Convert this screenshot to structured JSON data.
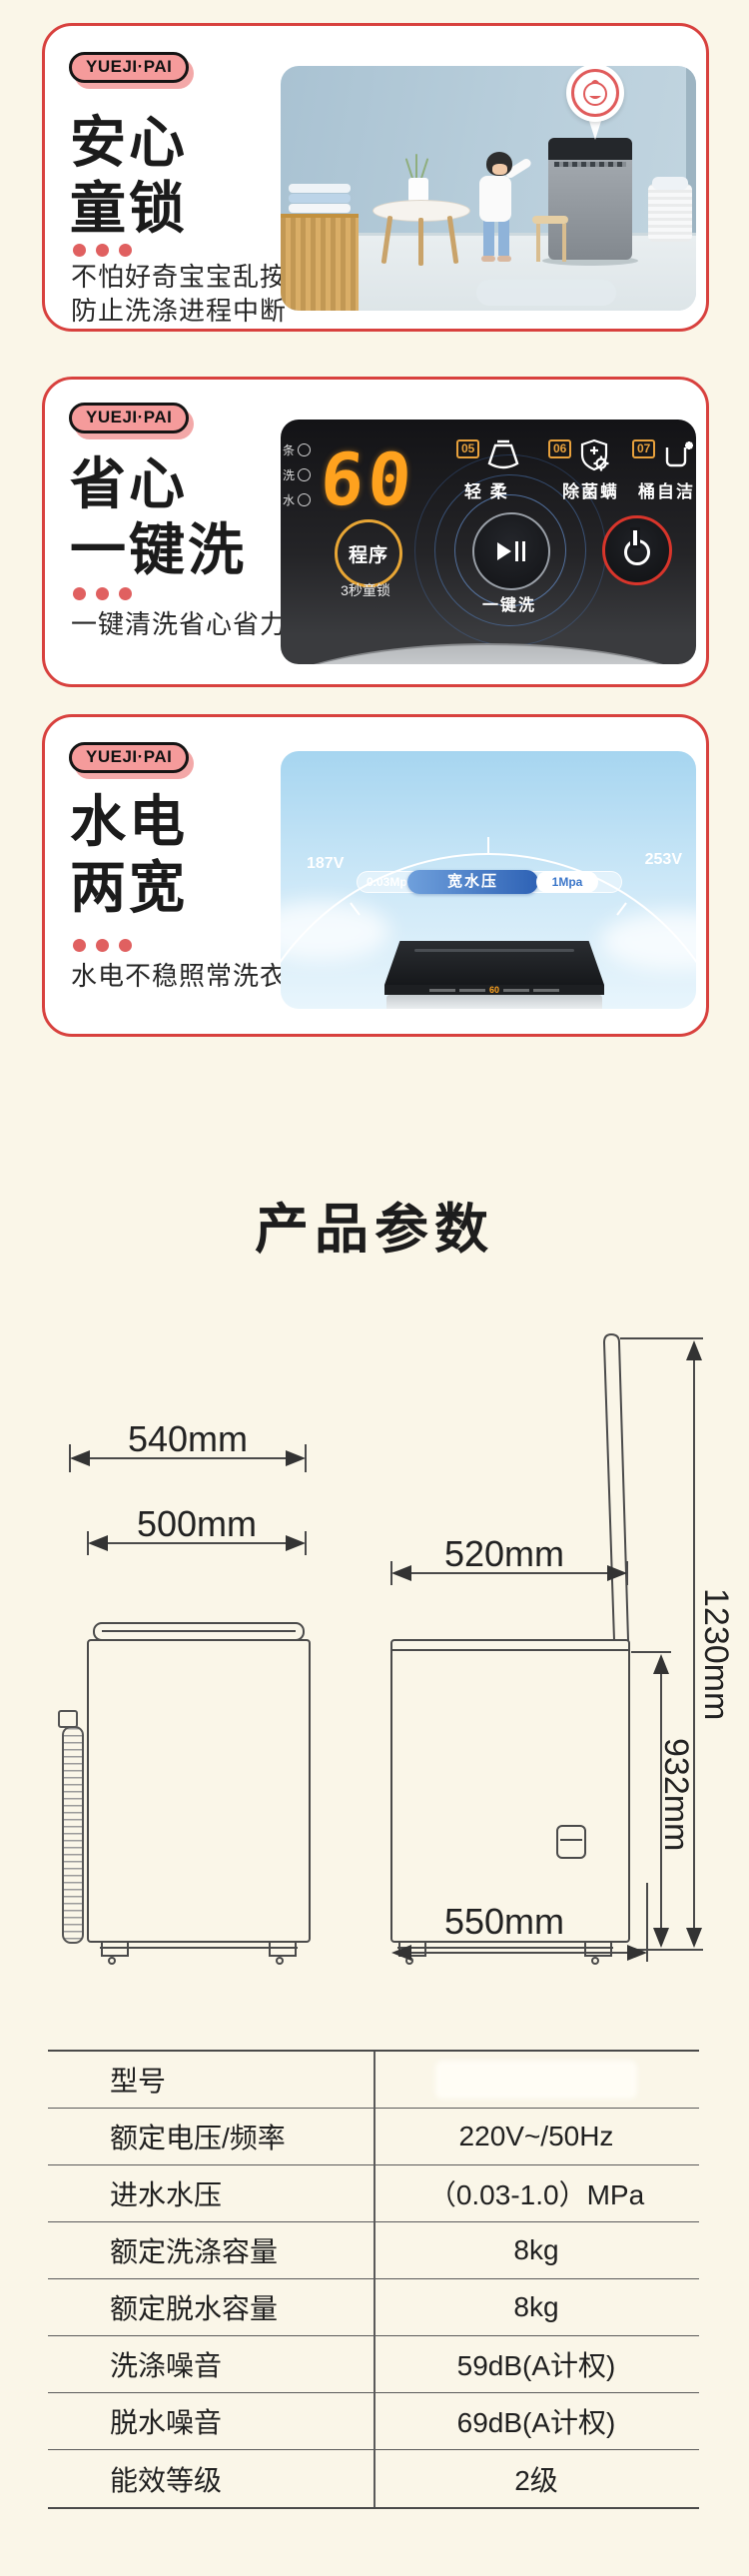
{
  "brand_badge": "YUEJI·PAI",
  "cards": [
    {
      "title": [
        "安心",
        "童锁"
      ],
      "desc": [
        "不怕好奇宝宝乱按",
        "防止洗涤进程中断"
      ]
    },
    {
      "title": [
        "省心",
        "一键洗"
      ],
      "desc": [
        "一键清洗省心省力"
      ],
      "panel": {
        "display": "60",
        "indicators": [
          "条",
          "洗",
          "水"
        ],
        "programs": [
          {
            "num": "05",
            "label": "轻 柔"
          },
          {
            "num": "06",
            "label": "除菌螨"
          },
          {
            "num": "07",
            "label": "桶自洁"
          }
        ],
        "program_button": "程序",
        "program_hint": "3秒童锁",
        "onekey_label": "一键洗"
      }
    },
    {
      "title": [
        "水电",
        "两宽"
      ],
      "desc": [
        "水电不稳照常洗衣"
      ],
      "gauge": {
        "voltage_min": "187V",
        "voltage_max": "253V",
        "pressure_min": "0.03Mpa",
        "pressure_label": "宽水压",
        "pressure_max": "1Mpa",
        "machine_display": "60"
      }
    }
  ],
  "section_title": "产品参数",
  "diagram": {
    "top_width": "540mm",
    "lid_width": "500mm",
    "side_width": "520mm",
    "total_height": "1230mm",
    "body_height": "932mm",
    "base_depth": "550mm"
  },
  "spec_table": {
    "rows": [
      {
        "label": "型号",
        "value": ""
      },
      {
        "label": "额定电压/频率",
        "value": "220V~/50Hz"
      },
      {
        "label": "进水水压",
        "value": "（0.03-1.0）MPa"
      },
      {
        "label": "额定洗涤容量",
        "value": "8kg"
      },
      {
        "label": "额定脱水容量",
        "value": "8kg"
      },
      {
        "label": "洗涤噪音",
        "value": "59dB(A计权)"
      },
      {
        "label": "脱水噪音",
        "value": "69dB(A计权)"
      },
      {
        "label": "能效等级",
        "value": "2级"
      }
    ]
  },
  "colors": {
    "page_bg": "#faf6e8",
    "card_border": "#d8413e",
    "badge_pink": "#f59b9b",
    "accent_dot_red": "#e06060",
    "digit_orange": "#ffa21e",
    "ring_blue": "#4c86d8",
    "power_red": "#d8352b",
    "program_yellow": "#e8a635",
    "pressure_blue": "#2e62b5"
  },
  "icons": {
    "baby_face_icon": "baby face in circular callout",
    "skirt_icon": "gentle-wash skirt glyph",
    "shield_gear_icon": "anti-mite shield with plus and gear",
    "bucket_sparkle_icon": "tub self-clean bucket with sparkle",
    "play_pause_icon": "play/pause",
    "power_icon": "power symbol"
  }
}
